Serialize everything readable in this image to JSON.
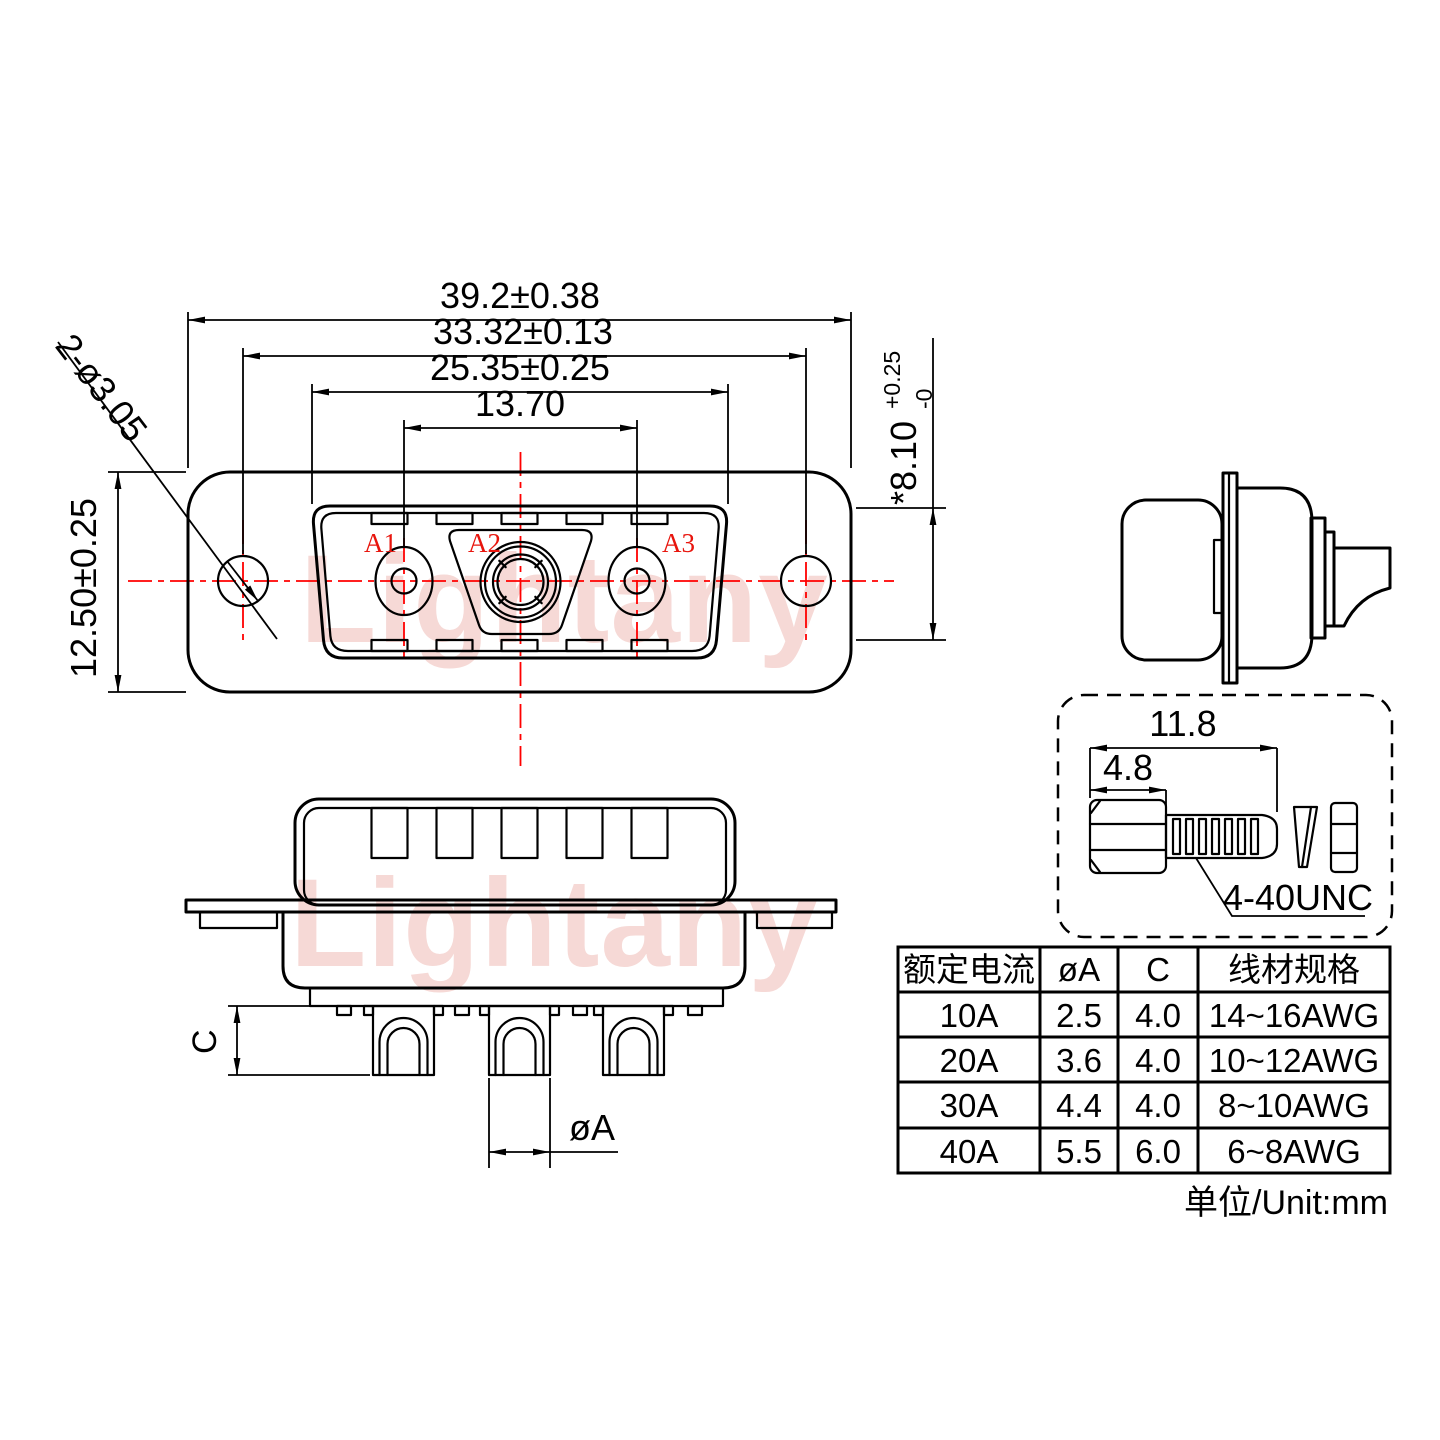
{
  "drawing": {
    "watermark": "Lightany",
    "front_view": {
      "dim_total_width": "39.2±0.38",
      "dim_hole_span": "33.32±0.13",
      "dim_shell_width": "25.35±0.25",
      "dim_contact_span": "13.70",
      "dim_height": "12.50±0.25",
      "dim_mount_holes": "2-ø3.05",
      "dim_shell_height": "*8.10",
      "dim_shell_height_tol_upper": "+0.25",
      "dim_shell_height_tol_lower": "-0",
      "contact_labels": [
        "A1",
        "A2",
        "A3"
      ]
    },
    "section_view": {
      "dim_cup_depth": "C",
      "dim_pin_diameter": "øA"
    },
    "screw_detail": {
      "dim_total_length": "11.8",
      "dim_head_length": "4.8",
      "thread_spec": "4-40UNC"
    },
    "spec_table": {
      "col_headers": [
        "额定电流",
        "øA",
        "C",
        "线材规格"
      ],
      "rows": [
        {
          "current": "10A",
          "dia": "2.5",
          "c": "4.0",
          "wire": "14~16AWG"
        },
        {
          "current": "20A",
          "dia": "3.6",
          "c": "4.0",
          "wire": "10~12AWG"
        },
        {
          "current": "30A",
          "dia": "4.4",
          "c": "4.0",
          "wire": "8~10AWG"
        },
        {
          "current": "40A",
          "dia": "5.5",
          "c": "6.0",
          "wire": "6~8AWG"
        }
      ],
      "unit_note": "单位/Unit:mm"
    },
    "colors": {
      "line": "#000000",
      "centerline": "#ff0000",
      "contact_label": "#e8150d",
      "watermark": "#f6d9d6"
    }
  }
}
